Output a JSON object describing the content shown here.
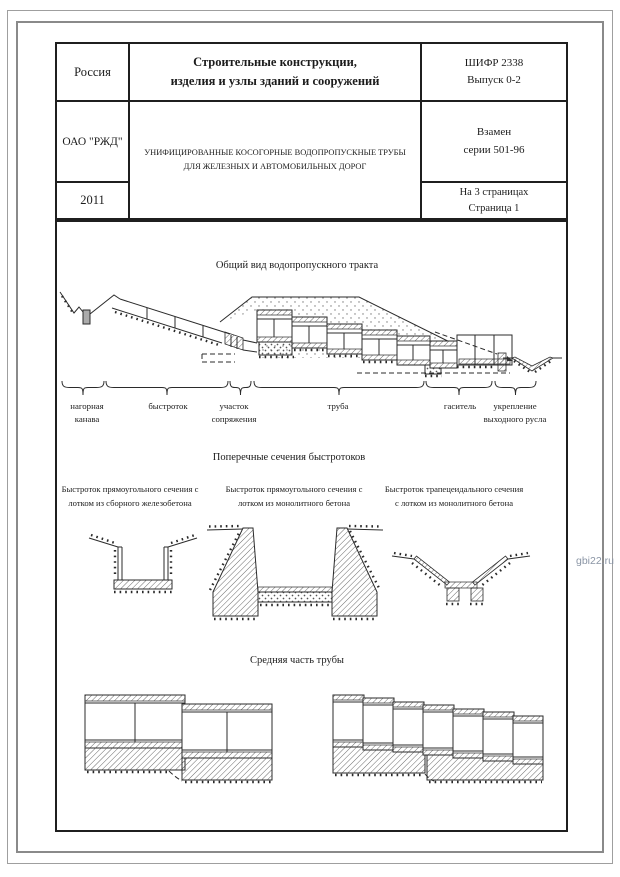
{
  "header": {
    "country": "Россия",
    "series_line1": "Строительные конструкции,",
    "series_line2": "изделия и узлы зданий и сооружений",
    "code_line1": "ШИФР 2338",
    "code_line2": "Выпуск 0-2",
    "organization": "ОАО \"РЖД\"",
    "document_title": "УНИФИЦИРОВАННЫЕ КОСОГОРНЫЕ ВОДОПРОПУСКНЫЕ ТРУБЫ ДЛЯ ЖЕЛЕЗНЫХ И АВТОМОБИЛЬНЫХ ДОРОГ",
    "replaces_line1": "Взамен",
    "replaces_line2": "серии 501-96",
    "year": "2011",
    "pages_line1": "На 3 страницах",
    "pages_line2": "Страница 1"
  },
  "general_view": {
    "title": "Общий вид водопропускного тракта",
    "labels": [
      "нагорная канава",
      "быстроток",
      "участок сопряжения",
      "труба",
      "гаситель",
      "укрепление выходного русла"
    ]
  },
  "cross_sections": {
    "title": "Поперечные сечения быстротоков",
    "captions": [
      "Быстроток прямоугольного сечения с лотком из сборного железобетона",
      "Быстроток прямоугольного сечения с лотком из монолитного бетона",
      "Быстроток трапецеидального сечения с лотком из монолитного бетона"
    ]
  },
  "pipe_middle": {
    "title": "Средняя часть трубы"
  },
  "watermark": "gbi22.ru"
}
